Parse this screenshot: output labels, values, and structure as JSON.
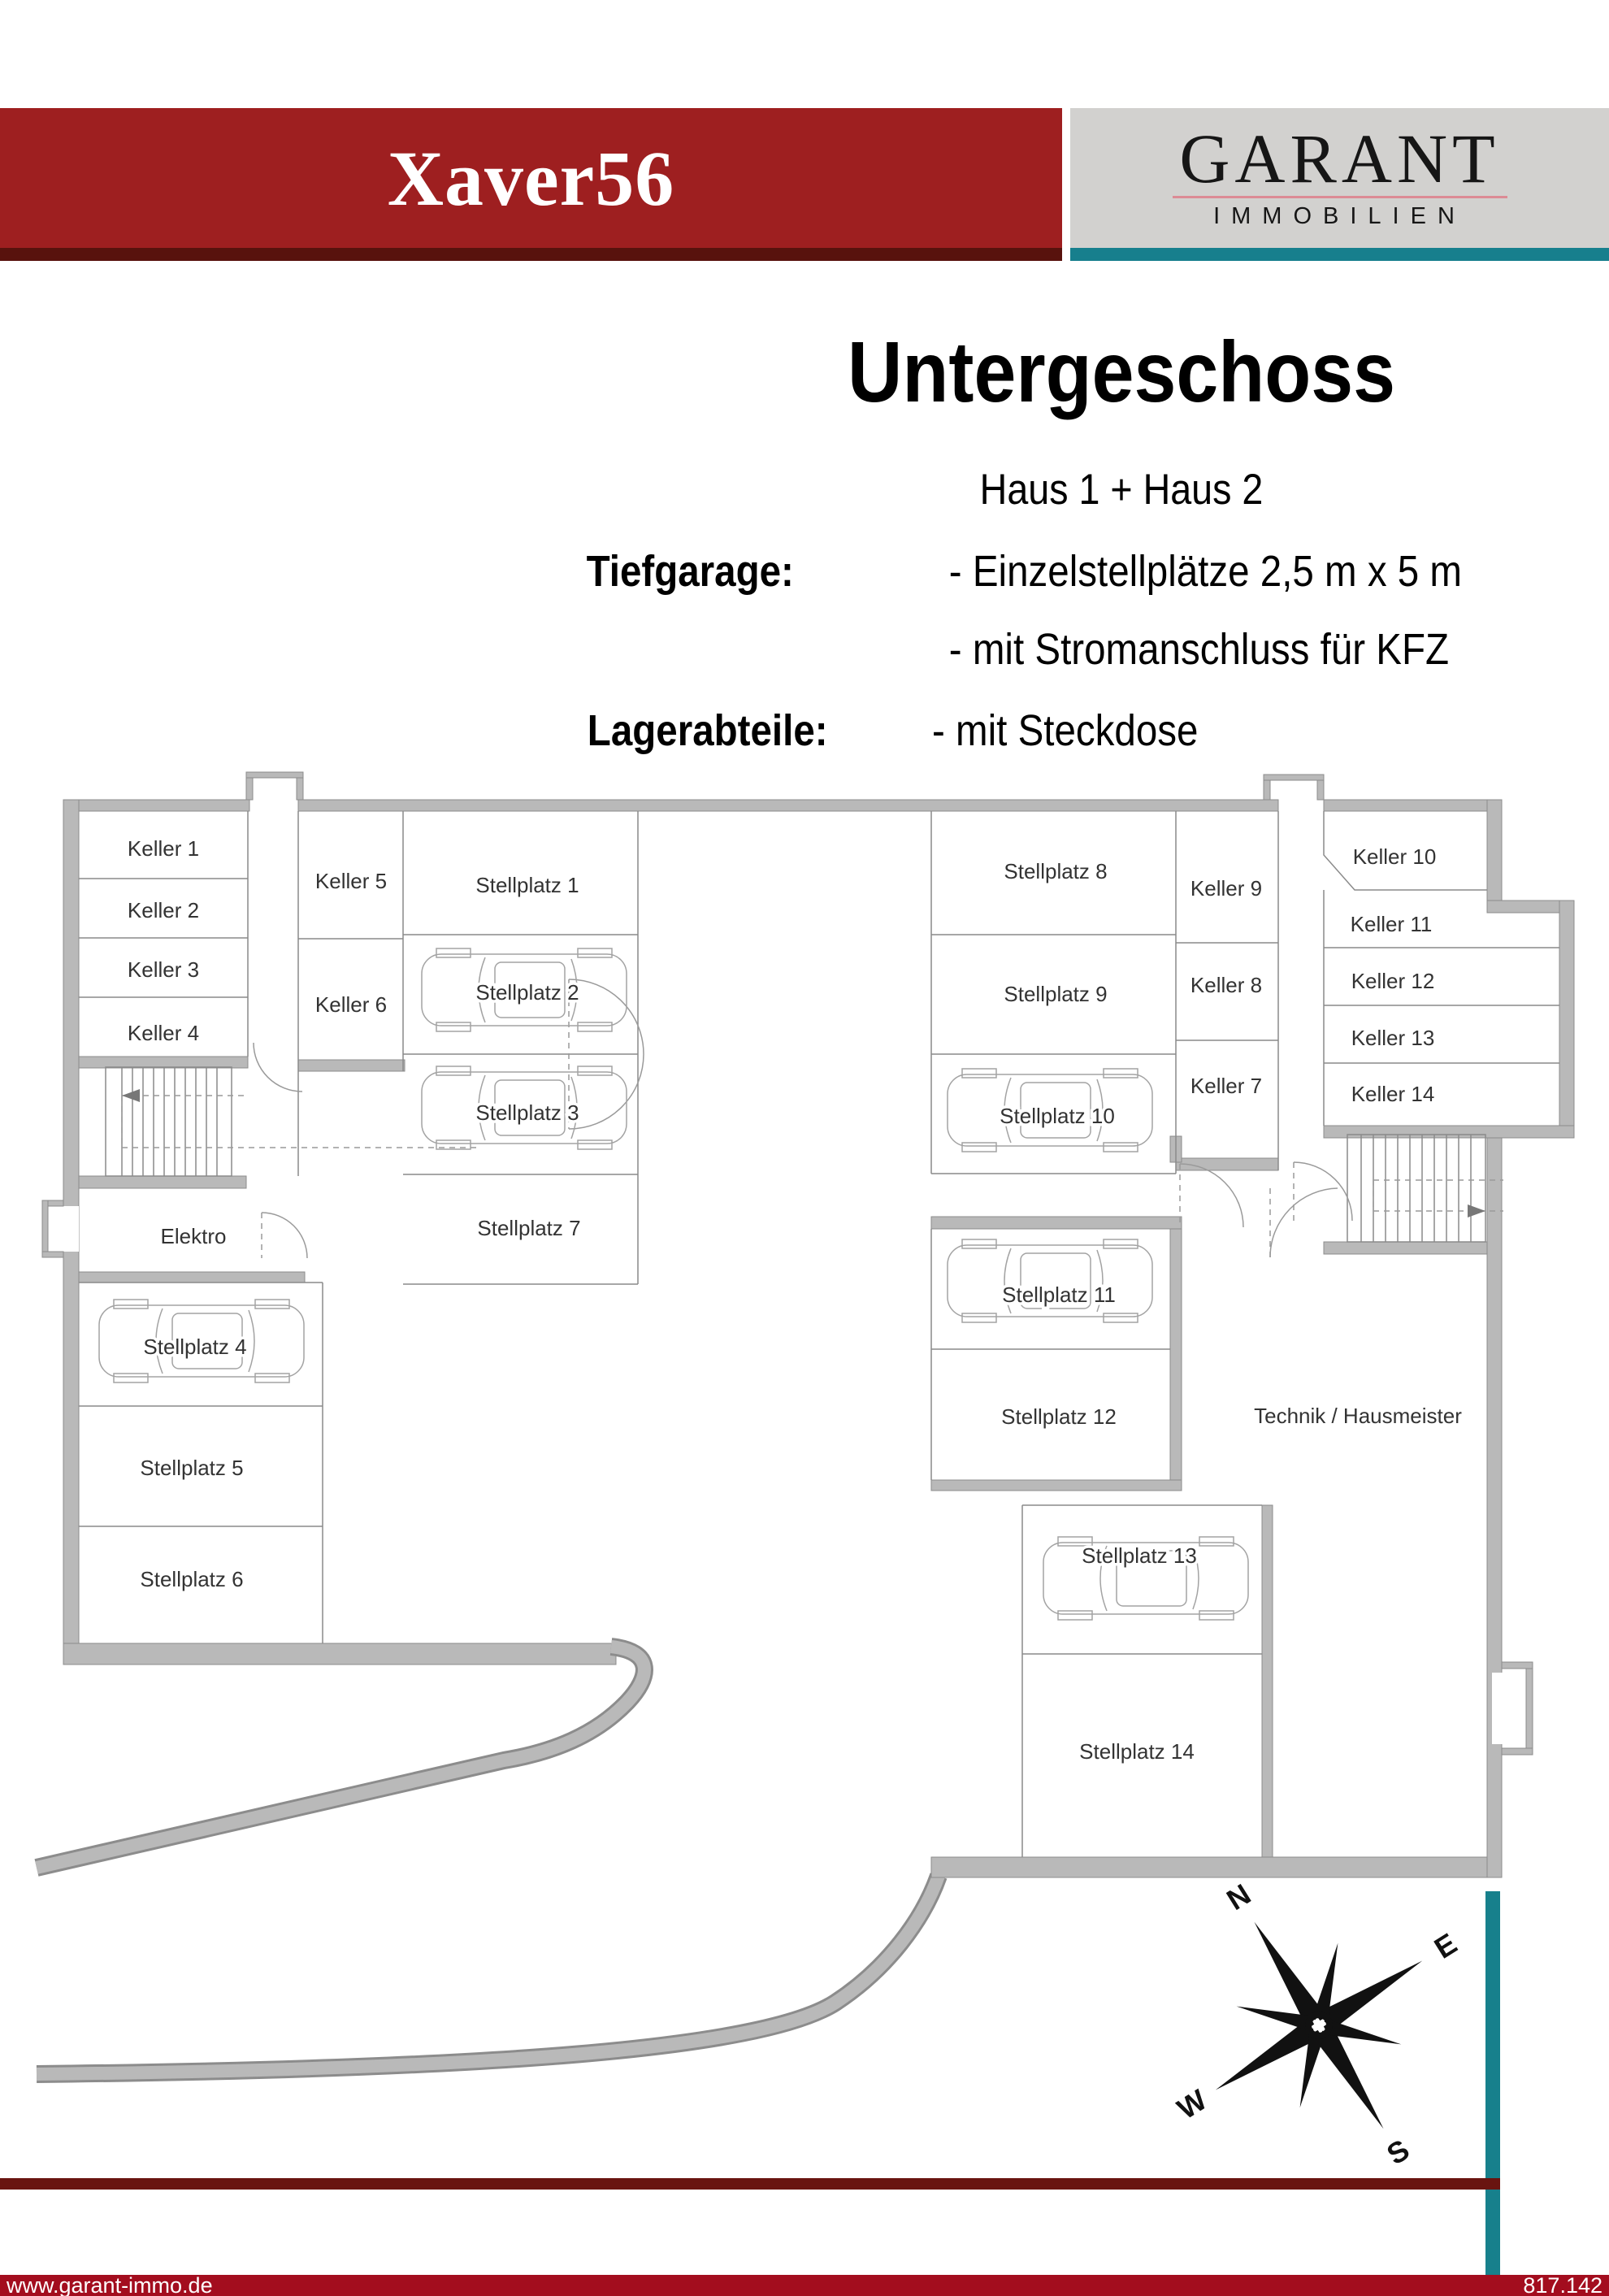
{
  "header": {
    "project": "Xaver56",
    "brand": "GARANT",
    "brand_sub": "IMMOBILIEN"
  },
  "title": {
    "main": "Untergeschoss",
    "sub": "Haus 1 + Haus 2",
    "row1_label": "Tiefgarage:",
    "row1_item1": "- Einzelstellplätze 2,5 m x 5 m",
    "row1_item2": "- mit Stromanschluss für KFZ",
    "row2_label": "Lagerabteile:",
    "row2_item1": "- mit Steckdose"
  },
  "plan": {
    "rooms": [
      {
        "label": "Keller 1"
      },
      {
        "label": "Keller 2"
      },
      {
        "label": "Keller 3"
      },
      {
        "label": "Keller 4"
      },
      {
        "label": "Keller 5"
      },
      {
        "label": "Keller 6"
      },
      {
        "label": "Stellplatz 1"
      },
      {
        "label": "Stellplatz 2"
      },
      {
        "label": "Stellplatz 3"
      },
      {
        "label": "Stellplatz 7"
      },
      {
        "label": "Elektro"
      },
      {
        "label": "Stellplatz 4"
      },
      {
        "label": "Stellplatz 5"
      },
      {
        "label": "Stellplatz 6"
      },
      {
        "label": "Stellplatz 8"
      },
      {
        "label": "Stellplatz 9"
      },
      {
        "label": "Stellplatz 10"
      },
      {
        "label": "Keller 9"
      },
      {
        "label": "Keller 8"
      },
      {
        "label": "Keller 7"
      },
      {
        "label": "Keller 10"
      },
      {
        "label": "Keller 11"
      },
      {
        "label": "Keller 12"
      },
      {
        "label": "Keller 13"
      },
      {
        "label": "Keller 14"
      },
      {
        "label": "Stellplatz 11"
      },
      {
        "label": "Stellplatz 12"
      },
      {
        "label": "Technik / Hausmeister"
      },
      {
        "label": "Stellplatz 13"
      },
      {
        "label": "Stellplatz 14"
      }
    ],
    "compass": {
      "n": "N",
      "e": "E",
      "s": "S",
      "w": "W"
    }
  },
  "footer": {
    "website": "www.garant-immo.de",
    "code": "817.142"
  },
  "colors": {
    "banner_red": "#9e1f20",
    "banner_dark_red": "#58120d",
    "logo_bg": "#d2d1cf",
    "logo_underline": "#dc8b95",
    "teal": "#17808c",
    "divider_dark_red": "#691410",
    "footer_red": "#a30d1e",
    "wall_gray": "#b9b9b9",
    "label_gray": "#333333"
  }
}
